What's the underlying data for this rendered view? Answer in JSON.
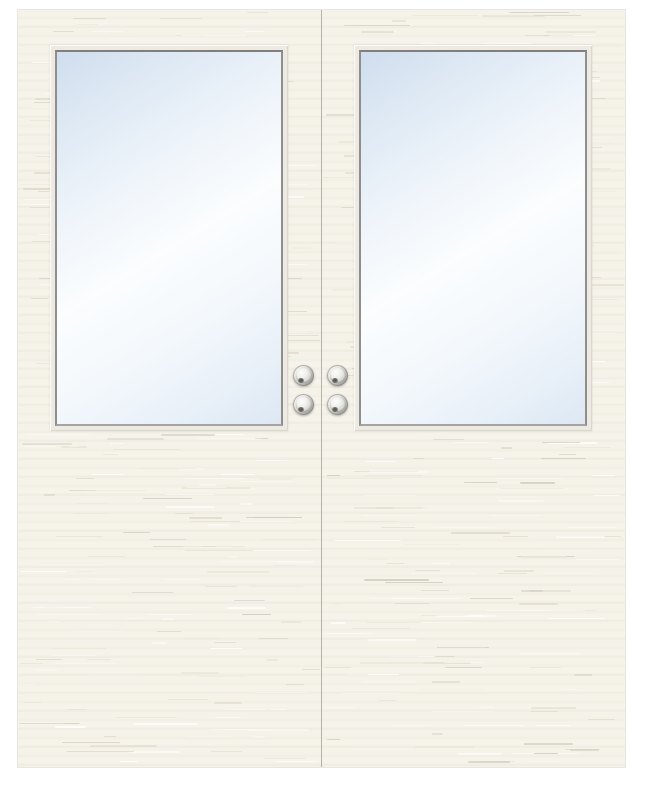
{
  "scene": {
    "title": "double-glazed-door-pair-render",
    "background_color": "#ffffff",
    "door": {
      "leaf_count": 2,
      "base_color": "#f5f2e9",
      "band_color": "#f0ede3",
      "edge_color": "#d6d2c7",
      "texture_palette": [
        "rgba(255,255,255,0.95)",
        "rgba(255,255,255,0.6)",
        "#e9e5d8",
        "#ddd8c9",
        "#cfccc2"
      ]
    },
    "seam_color": "#b5b2aa",
    "window": {
      "count": 2,
      "frame_outer_color": "#eceae3",
      "frame_inner_color": "#8f8e8a",
      "glass_blue": "#cfdded",
      "glass_white": "#fbfdfe"
    },
    "hardware": {
      "knob_count": 4,
      "ring_light": "#fdfdfc",
      "ring_dark": "#8a8a86",
      "face_light": "#fdfdfc",
      "face_dark": "#b4b4b0",
      "notch_color": "#53524d"
    }
  },
  "doors": [
    {
      "id": "left",
      "label": "left door leaf"
    },
    {
      "id": "right",
      "label": "right door leaf"
    }
  ],
  "knobs": [
    {
      "id": "knob-top-left",
      "x": 275,
      "y": 355
    },
    {
      "id": "knob-top-right",
      "x": 309,
      "y": 355
    },
    {
      "id": "knob-bottom-left",
      "x": 275,
      "y": 384
    },
    {
      "id": "knob-bottom-right",
      "x": 309,
      "y": 384
    }
  ]
}
